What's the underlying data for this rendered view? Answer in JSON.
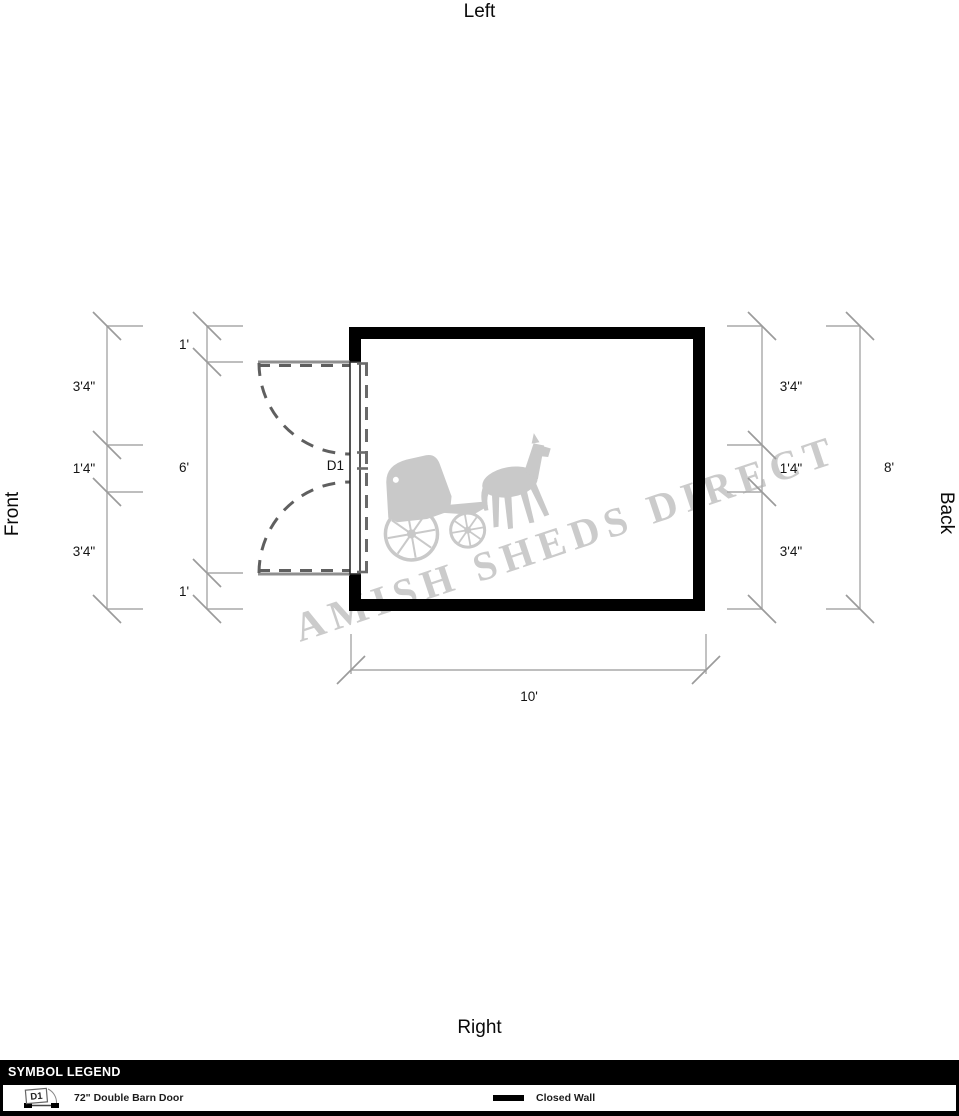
{
  "orientation": {
    "top": "Left",
    "left": "Front",
    "right": "Back",
    "bottom": "Right"
  },
  "dimensions": {
    "left_outer": [
      "3'4\"",
      "1'4\"",
      "3'4\""
    ],
    "left_inner": [
      "1'",
      "6'",
      "1'"
    ],
    "right_inner": [
      "3'4\"",
      "1'4\"",
      "3'4\""
    ],
    "right_outer": "8'",
    "bottom": "10'"
  },
  "door": {
    "label": "D1"
  },
  "watermark": {
    "text": "AMISH SHEDS DIRECT",
    "icon": "horse-and-buggy"
  },
  "legend": {
    "header": "SYMBOL LEGEND",
    "items": [
      {
        "symbol": "D1",
        "label": "72\" Double Barn Door"
      },
      {
        "symbol": "closed-wall",
        "label": "Closed Wall"
      }
    ]
  },
  "colors": {
    "wall": "#000000",
    "dimension_line": "#a9a9a9",
    "door_dash": "#5f5f5f",
    "watermark": "#cbcbcb"
  }
}
